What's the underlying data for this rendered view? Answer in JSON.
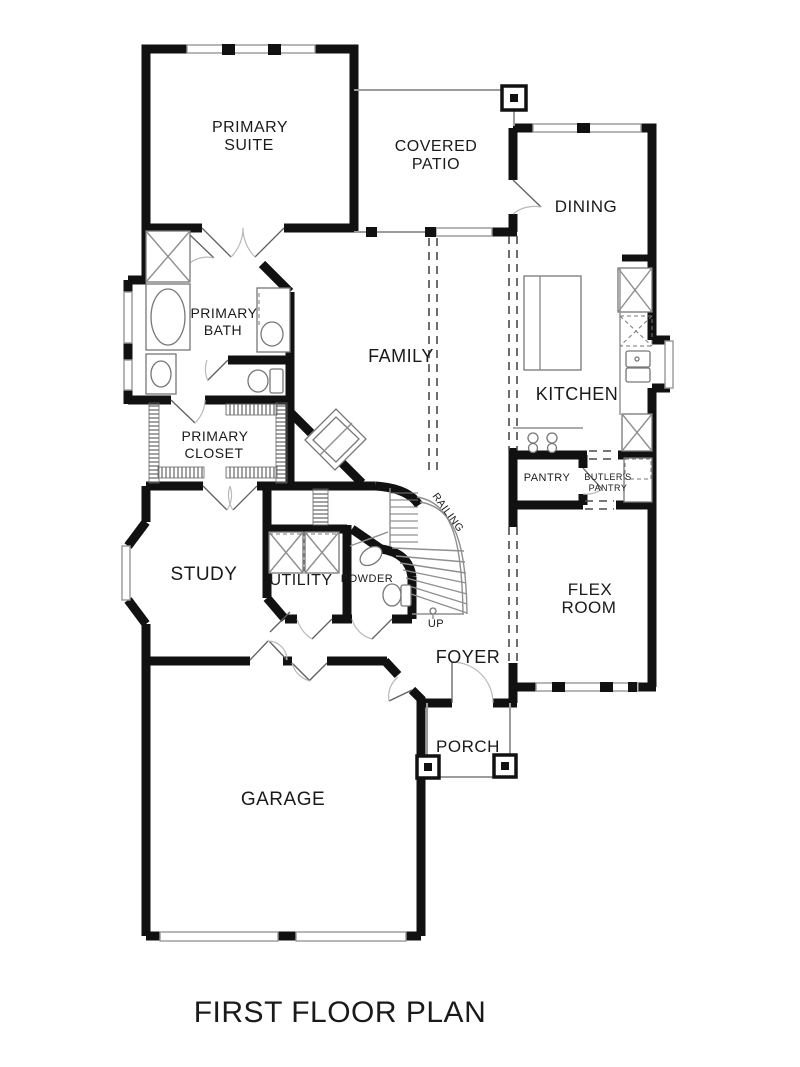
{
  "title": "FIRST FLOOR PLAN",
  "rooms": {
    "primary_suite": {
      "line1": "PRIMARY",
      "line2": "SUITE"
    },
    "covered_patio": {
      "line1": "COVERED",
      "line2": "PATIO"
    },
    "dining": "DINING",
    "kitchen": "KITCHEN",
    "family": "FAMILY",
    "primary_bath": {
      "line1": "PRIMARY",
      "line2": "BATH"
    },
    "primary_closet": {
      "line1": "PRIMARY",
      "line2": "CLOSET"
    },
    "pantry": "PANTRY",
    "butlers_pantry": {
      "line1": "BUTLER'S",
      "line2": "PANTRY"
    },
    "study": "STUDY",
    "utility": "UTILITY",
    "powder": "POWDER",
    "flex_room": {
      "line1": "FLEX",
      "line2": "ROOM"
    },
    "foyer": "FOYER",
    "porch": "PORCH",
    "garage": "GARAGE"
  },
  "stairs": {
    "railing": "RAILING",
    "up": "UP"
  },
  "colors": {
    "wall": "#111111",
    "background": "#ffffff",
    "thin_line": "#8f8f8f",
    "text": "#1a1a1a"
  }
}
